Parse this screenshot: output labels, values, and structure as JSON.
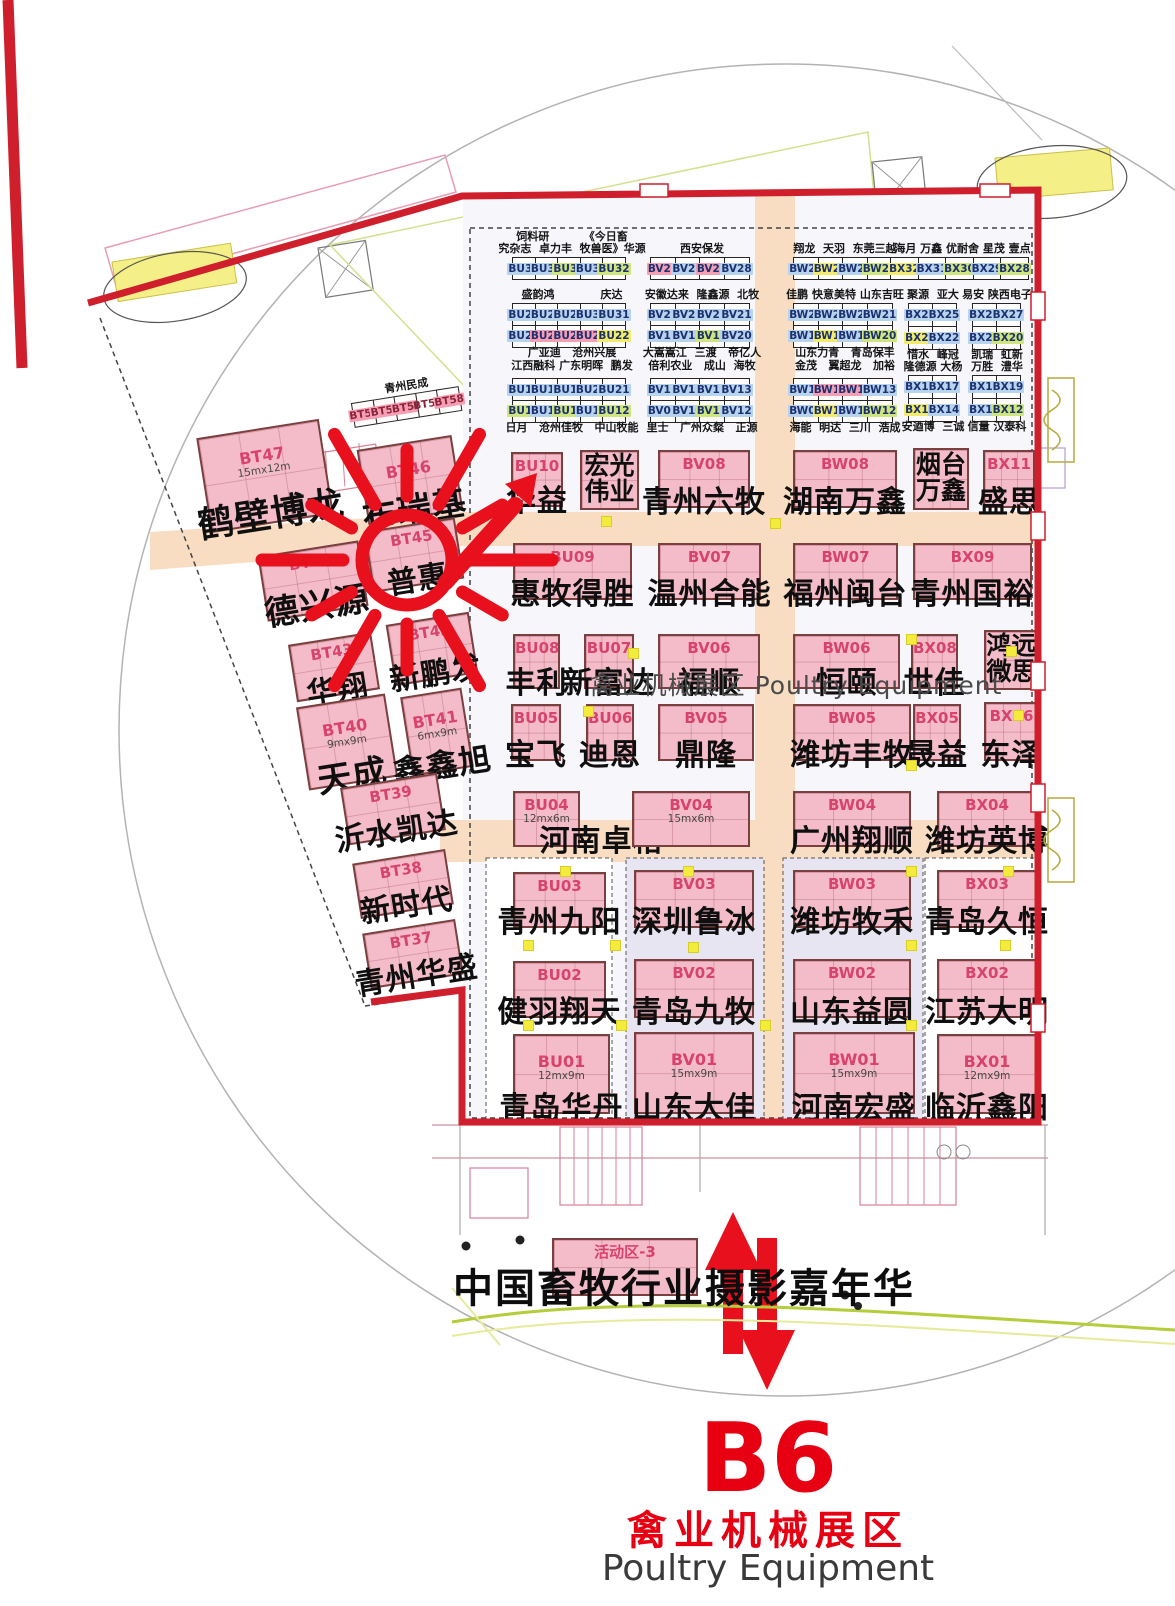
{
  "hall": {
    "center_label": "禽业机械展区 Poultry Equipment",
    "footer_code": "B6",
    "footer_zone_cn": "禽业机械展区",
    "footer_zone_en": "Poultry Equipment"
  },
  "activity": {
    "code": "活动区-3",
    "caption": "中国畜牧行业摄影嘉年华"
  },
  "highlight_marker": {
    "circled_booth": "BT45",
    "circled_company": "普惠",
    "arrow_target_booth": "BU10",
    "sun_cx": 407,
    "sun_cy": 560,
    "color": "#e8101c"
  },
  "colors": {
    "wall_red": "#cf1f2c",
    "booth_pink": "#f4bcc9",
    "corridor_peach": "#f8ddc3",
    "panel_lavender": "#e7e5f2",
    "hl_blue": "#b7d3ee",
    "hl_pink": "#f69fb4",
    "hl_green": "#cfe57d",
    "hl_yellow": "#f2ec6a"
  },
  "left_wing": {
    "strip": {
      "label": "青州民成",
      "x": 352,
      "y": 394,
      "cells": [
        {
          "c": "BT54",
          "h": "pink"
        },
        {
          "c": "BT55",
          "h": "pink"
        },
        {
          "c": "BT56",
          "h": "pink"
        },
        {
          "c": "BT57",
          "h": "white"
        },
        {
          "c": "BT58",
          "h": "pink"
        }
      ]
    },
    "booths": [
      {
        "code": "BT47",
        "size": "15mx12m",
        "name": "鹤壁博龙",
        "x": 203,
        "y": 428,
        "w": 124,
        "h": 96,
        "ns": 36
      },
      {
        "code": "BT46",
        "name": "布瑞基",
        "x": 362,
        "y": 442,
        "w": 96,
        "h": 76,
        "ns": 34
      },
      {
        "code": "BT45",
        "name": "普惠",
        "x": 368,
        "y": 524,
        "w": 92,
        "h": 62,
        "ns": 30
      },
      {
        "code": "BT44",
        "name": "德兴源",
        "x": 262,
        "y": 548,
        "w": 102,
        "h": 66,
        "ns": 34
      },
      {
        "code": "BT43",
        "name": "华翔",
        "x": 292,
        "y": 638,
        "w": 84,
        "h": 58,
        "ns": 30
      },
      {
        "code": "BT42",
        "name": "新鹏发",
        "x": 390,
        "y": 618,
        "w": 84,
        "h": 62,
        "ns": 30
      },
      {
        "code": "BT40",
        "size": "9mx9m",
        "name": "天成",
        "x": 302,
        "y": 700,
        "w": 90,
        "h": 84,
        "ns": 34
      },
      {
        "code": "BT41",
        "size": "6mx9m",
        "name": "鑫鑫旭",
        "x": 406,
        "y": 692,
        "w": 62,
        "h": 80,
        "ns": 32
      },
      {
        "code": "BT39",
        "name": "沂水凯达",
        "x": 344,
        "y": 780,
        "w": 98,
        "h": 58,
        "ns": 30
      },
      {
        "code": "BT38",
        "name": "新时代",
        "x": 356,
        "y": 856,
        "w": 94,
        "h": 56,
        "ns": 30
      },
      {
        "code": "BT37",
        "name": "青州华盛",
        "x": 366,
        "y": 926,
        "w": 94,
        "h": 56,
        "ns": 30
      }
    ]
  },
  "small_booth_groups": [
    {
      "id": "bu-a",
      "x": 512,
      "y": 257,
      "cw": 24,
      "ch": 23,
      "above": [
        "饲料研         《今日畜",
        "究杂志  卓力丰  牧兽医》华源"
      ],
      "below": [],
      "rows": [
        [
          {
            "c": "BU36",
            "h": "blue"
          },
          {
            "c": "BU35",
            "h": "blue"
          },
          {
            "c": "BU34",
            "h": "green"
          },
          {
            "c": "BU33",
            "h": "blue"
          },
          {
            "c": "BU32",
            "h": "green"
          }
        ]
      ]
    },
    {
      "id": "bu-b",
      "x": 512,
      "y": 303,
      "cw": 24,
      "ch": 23,
      "above": [
        "盛韵鸿            庆达"
      ],
      "below": [
        "广亚迪   沧州兴展",
        "江西融科 广东明晖  鹏发"
      ],
      "rows": [
        [
          {
            "c": "BU27",
            "h": "blue"
          },
          {
            "c": "BU28",
            "h": "blue"
          },
          {
            "c": "BU29",
            "h": "blue"
          },
          {
            "c": "BU30",
            "h": "blue"
          },
          {
            "c": "BU31",
            "h": "blue"
          }
        ],
        [
          {
            "c": "BU26",
            "h": "blue"
          },
          {
            "c": "BU25",
            "h": "pink"
          },
          {
            "c": "BU24",
            "h": "pink"
          },
          {
            "c": "BU23",
            "h": "pink"
          },
          {
            "c": "BU22",
            "h": "yellow"
          }
        ]
      ]
    },
    {
      "id": "bu-c",
      "x": 512,
      "y": 378,
      "cw": 24,
      "ch": 23,
      "above": [],
      "below": [
        "日月   沧州佳牧   中山牧能"
      ],
      "rows": [
        [
          {
            "c": "BU17",
            "h": "blue"
          },
          {
            "c": "BU18",
            "h": "blue"
          },
          {
            "c": "BU19",
            "h": "blue"
          },
          {
            "c": "BU20",
            "h": "blue"
          },
          {
            "c": "BU21",
            "h": "blue"
          }
        ],
        [
          {
            "c": "BU16",
            "h": "green"
          },
          {
            "c": "BU15",
            "h": "blue"
          },
          {
            "c": "BU14",
            "h": "green"
          },
          {
            "c": "BU13",
            "h": "blue"
          },
          {
            "c": "BU12",
            "h": "green"
          }
        ]
      ]
    },
    {
      "id": "bv-a",
      "x": 650,
      "y": 257,
      "cw": 26,
      "ch": 23,
      "above": [
        "西安保发"
      ],
      "below": [],
      "rows": [
        [
          {
            "c": "BV25",
            "h": "pink"
          },
          {
            "c": "BV26",
            "h": "blue"
          },
          {
            "c": "BV27",
            "h": "pink"
          },
          {
            "c": "BV28",
            "h": "blue"
          }
        ]
      ]
    },
    {
      "id": "bv-b",
      "x": 650,
      "y": 303,
      "cw": 26,
      "ch": 23,
      "above": [
        "安徽达来  隆鑫源  北牧"
      ],
      "below": [
        "大嵩嵩江  三渡   帝亿人",
        "倍利农业   成山  海牧"
      ],
      "rows": [
        [
          {
            "c": "BV24",
            "h": "blue"
          },
          {
            "c": "BV23",
            "h": "blue"
          },
          {
            "c": "BV22",
            "h": "blue"
          },
          {
            "c": "BV21",
            "h": "blue"
          }
        ],
        [
          {
            "c": "BV17",
            "h": "blue"
          },
          {
            "c": "BV18",
            "h": "blue"
          },
          {
            "c": "BV19",
            "h": "green"
          },
          {
            "c": "BV20",
            "h": "blue"
          }
        ]
      ]
    },
    {
      "id": "bv-c",
      "x": 650,
      "y": 378,
      "cw": 26,
      "ch": 23,
      "above": [],
      "below": [
        "里士   广州众粲   正源"
      ],
      "rows": [
        [
          {
            "c": "BV16",
            "h": "blue"
          },
          {
            "c": "BV15",
            "h": "blue"
          },
          {
            "c": "BV14",
            "h": "blue"
          },
          {
            "c": "BV13",
            "h": "blue"
          }
        ],
        [
          {
            "c": "BV09",
            "h": "blue"
          },
          {
            "c": "BV10",
            "h": "blue"
          },
          {
            "c": "BV11",
            "h": "green"
          },
          {
            "c": "BV12",
            "h": "blue"
          }
        ]
      ]
    },
    {
      "id": "bw-a",
      "x": 793,
      "y": 257,
      "cw": 26,
      "ch": 23,
      "above": [
        "翔龙  天羽  东莞三越"
      ],
      "below": [],
      "rows": [
        [
          {
            "c": "BW25",
            "h": "blue"
          },
          {
            "c": "BW26",
            "h": "yellow"
          },
          {
            "c": "BW27",
            "h": "blue"
          },
          {
            "c": "BW28",
            "h": "green"
          }
        ]
      ]
    },
    {
      "id": "bw-b",
      "x": 793,
      "y": 303,
      "cw": 26,
      "ch": 23,
      "above": [
        "佳鹏 快意美特 山东吉旺"
      ],
      "below": [
        "山东力青   青岛保丰",
        "金茂   翼超龙   加裕"
      ],
      "rows": [
        [
          {
            "c": "BW24",
            "h": "blue"
          },
          {
            "c": "BW23",
            "h": "blue"
          },
          {
            "c": "BW22",
            "h": "blue"
          },
          {
            "c": "BW21",
            "h": "blue"
          }
        ],
        [
          {
            "c": "BW17",
            "h": "blue"
          },
          {
            "c": "BW18",
            "h": "yellow"
          },
          {
            "c": "BW19",
            "h": "blue"
          },
          {
            "c": "BW20",
            "h": "green"
          }
        ]
      ]
    },
    {
      "id": "bw-c",
      "x": 793,
      "y": 378,
      "cw": 26,
      "ch": 23,
      "above": [],
      "below": [
        "海能  明达  三川  浩成"
      ],
      "rows": [
        [
          {
            "c": "BW16",
            "h": "blue"
          },
          {
            "c": "BW15",
            "h": "pink"
          },
          {
            "c": "BW14",
            "h": "pink"
          },
          {
            "c": "BW13",
            "h": "blue"
          }
        ],
        [
          {
            "c": "BW09",
            "h": "blue"
          },
          {
            "c": "BW10",
            "h": "yellow"
          },
          {
            "c": "BW11",
            "h": "blue"
          },
          {
            "c": "BW12",
            "h": "green"
          }
        ]
      ]
    },
    {
      "id": "bx-a",
      "x": 890,
      "y": 257,
      "cw": 29,
      "ch": 23,
      "above": [
        "海月 万鑫 优耐舍 星茂 壹点"
      ],
      "below": [],
      "rows": [
        [
          {
            "c": "BX32",
            "h": "yellow"
          },
          {
            "c": "BX31",
            "h": "blue"
          },
          {
            "c": "BX30",
            "h": "green"
          },
          {
            "c": "BX29",
            "h": "blue"
          },
          {
            "c": "BX28",
            "h": "green"
          }
        ]
      ]
    },
    {
      "id": "bx-b1",
      "x": 908,
      "y": 303,
      "cw": 25,
      "ch": 24,
      "above": [
        "聚源  亚大"
      ],
      "below": [],
      "rows": [
        [
          {
            "c": "BX24",
            "h": "blue"
          },
          {
            "c": "BX25",
            "h": "blue"
          }
        ],
        [
          {
            "c": "BX23",
            "h": "yellow"
          },
          {
            "c": "BX22",
            "h": "blue"
          }
        ]
      ]
    },
    {
      "id": "bx-b2",
      "x": 972,
      "y": 303,
      "cw": 25,
      "ch": 24,
      "above": [
        "易安 陕西电子"
      ],
      "below": [],
      "rows": [
        [
          {
            "c": "BX26",
            "h": "blue"
          },
          {
            "c": "BX27",
            "h": "blue"
          }
        ],
        [
          {
            "c": "BX21",
            "h": "blue"
          },
          {
            "c": "BX20",
            "h": "green"
          }
        ]
      ]
    },
    {
      "id": "bx-c1",
      "x": 908,
      "y": 375,
      "cw": 25,
      "ch": 24,
      "above": [
        "惜水  峰冠",
        "隆德源 大杨"
      ],
      "below": [
        "安逎博  三诚"
      ],
      "rows": [
        [
          {
            "c": "BX16",
            "h": "blue"
          },
          {
            "c": "BX17",
            "h": "blue"
          }
        ],
        [
          {
            "c": "BX15",
            "h": "yellow"
          },
          {
            "c": "BX14",
            "h": "blue"
          }
        ]
      ]
    },
    {
      "id": "bx-c2",
      "x": 972,
      "y": 375,
      "cw": 25,
      "ch": 24,
      "above": [
        "凯瑞  虹新",
        "万胜  澧华"
      ],
      "below": [
        "信量 汉泰科"
      ],
      "rows": [
        [
          {
            "c": "BX18",
            "h": "blue"
          },
          {
            "c": "BX19",
            "h": "blue"
          }
        ],
        [
          {
            "c": "BX13",
            "h": "blue"
          },
          {
            "c": "BX12",
            "h": "green"
          }
        ]
      ]
    }
  ],
  "main_booths": [
    {
      "code": "BU10",
      "name": "华益",
      "x": 511,
      "y": 452,
      "w": 52,
      "h": 55
    },
    {
      "code": "",
      "name": "宏光伟业",
      "stack": true,
      "x": 580,
      "y": 450,
      "w": 59,
      "h": 60
    },
    {
      "code": "BV08",
      "name": "青州六牧",
      "x": 658,
      "y": 450,
      "w": 92,
      "h": 58
    },
    {
      "code": "BW08",
      "name": "湖南万鑫",
      "x": 793,
      "y": 450,
      "w": 104,
      "h": 58
    },
    {
      "code": "",
      "name": "烟台万鑫",
      "stack": true,
      "x": 913,
      "y": 448,
      "w": 56,
      "h": 62
    },
    {
      "code": "BX11",
      "name": "盛思",
      "x": 983,
      "y": 450,
      "w": 52,
      "h": 58
    },
    {
      "code": "BU09",
      "name": "惠牧得胜",
      "x": 513,
      "y": 543,
      "w": 119,
      "h": 57
    },
    {
      "code": "BV07",
      "name": "温州合能",
      "x": 658,
      "y": 543,
      "w": 103,
      "h": 57
    },
    {
      "code": "BW07",
      "name": "福州闽台",
      "x": 793,
      "y": 543,
      "w": 105,
      "h": 57
    },
    {
      "code": "BX09",
      "name": "青州国裕",
      "x": 913,
      "y": 543,
      "w": 119,
      "h": 57
    },
    {
      "code": "BU08",
      "name": "丰利",
      "x": 513,
      "y": 634,
      "w": 47,
      "h": 55
    },
    {
      "code": "BU07",
      "name": "新富达",
      "x": 584,
      "y": 634,
      "w": 50,
      "h": 55
    },
    {
      "code": "BV06",
      "name": "福顺",
      "x": 658,
      "y": 634,
      "w": 102,
      "h": 55
    },
    {
      "code": "BW06",
      "name": "恒颐",
      "x": 793,
      "y": 634,
      "w": 107,
      "h": 55
    },
    {
      "code": "BX08",
      "name": "世佳",
      "x": 911,
      "y": 634,
      "w": 47,
      "h": 55
    },
    {
      "code": "",
      "name": "鸿远微思",
      "stack": true,
      "x": 984,
      "y": 630,
      "w": 55,
      "h": 60
    },
    {
      "code": "BU05",
      "name": "宝飞",
      "x": 511,
      "y": 704,
      "w": 50,
      "h": 57
    },
    {
      "code": "BU06",
      "name": "迪恩",
      "x": 586,
      "y": 704,
      "w": 48,
      "h": 57
    },
    {
      "code": "BV05",
      "name": "鼎隆",
      "x": 658,
      "y": 704,
      "w": 96,
      "h": 57
    },
    {
      "code": "BW05",
      "name": "潍坊丰牧",
      "x": 793,
      "y": 704,
      "w": 118,
      "h": 57
    },
    {
      "code": "BX05",
      "name": "晟益",
      "x": 913,
      "y": 704,
      "w": 48,
      "h": 57
    },
    {
      "code": "BX06",
      "name": "东泽",
      "x": 984,
      "y": 702,
      "w": 55,
      "h": 59
    },
    {
      "code": "BU04",
      "size": "12mx6m",
      "name": "河南卓格",
      "name_dx": 55,
      "x": 513,
      "y": 791,
      "w": 67,
      "h": 56
    },
    {
      "code": "BV04",
      "size": "15mx6m",
      "name": "",
      "x": 632,
      "y": 791,
      "w": 118,
      "h": 56
    },
    {
      "code": "BW04",
      "name": "广州翔顺",
      "x": 793,
      "y": 791,
      "w": 118,
      "h": 56
    },
    {
      "code": "BX04",
      "name": "潍坊英博",
      "x": 937,
      "y": 791,
      "w": 100,
      "h": 56
    },
    {
      "code": "BU03",
      "name": "青州九阳",
      "x": 513,
      "y": 872,
      "w": 93,
      "h": 56
    },
    {
      "code": "BV03",
      "name": "深圳鲁冰",
      "x": 634,
      "y": 870,
      "w": 120,
      "h": 58
    },
    {
      "code": "BW03",
      "name": "潍坊牧禾",
      "x": 793,
      "y": 870,
      "w": 118,
      "h": 58
    },
    {
      "code": "BX03",
      "name": "青岛久恒",
      "x": 937,
      "y": 870,
      "w": 100,
      "h": 58
    },
    {
      "code": "BU02",
      "name": "健羽翔天",
      "x": 513,
      "y": 961,
      "w": 93,
      "h": 57
    },
    {
      "code": "BV02",
      "name": "青岛九牧",
      "x": 634,
      "y": 959,
      "w": 120,
      "h": 59
    },
    {
      "code": "BW02",
      "name": "山东益圆",
      "x": 793,
      "y": 959,
      "w": 118,
      "h": 59
    },
    {
      "code": "BX02",
      "name": "江苏大明",
      "x": 937,
      "y": 959,
      "w": 100,
      "h": 59
    },
    {
      "code": "BU01",
      "size": "12mx9m",
      "name": "青岛华丹",
      "x": 513,
      "y": 1034,
      "w": 97,
      "h": 80
    },
    {
      "code": "BV01",
      "size": "15mx9m",
      "name": "山东大佳",
      "x": 634,
      "y": 1032,
      "w": 120,
      "h": 82
    },
    {
      "code": "BW01",
      "size": "15mx9m",
      "name": "河南宏盛",
      "x": 793,
      "y": 1032,
      "w": 122,
      "h": 82
    },
    {
      "code": "BX01",
      "size": "12mx9m",
      "name": "临沂鑫阳",
      "x": 937,
      "y": 1034,
      "w": 100,
      "h": 80
    }
  ],
  "pillars": [
    [
      601,
      516
    ],
    [
      770,
      518
    ],
    [
      628,
      648
    ],
    [
      906,
      634
    ],
    [
      1006,
      646
    ],
    [
      583,
      706
    ],
    [
      906,
      760
    ],
    [
      1013,
      710
    ],
    [
      560,
      866
    ],
    [
      683,
      866
    ],
    [
      906,
      866
    ],
    [
      1003,
      866
    ],
    [
      523,
      940
    ],
    [
      610,
      940
    ],
    [
      688,
      942
    ],
    [
      906,
      940
    ],
    [
      1000,
      940
    ],
    [
      523,
      1020
    ],
    [
      616,
      1020
    ],
    [
      760,
      1020
    ],
    [
      906,
      1020
    ]
  ]
}
